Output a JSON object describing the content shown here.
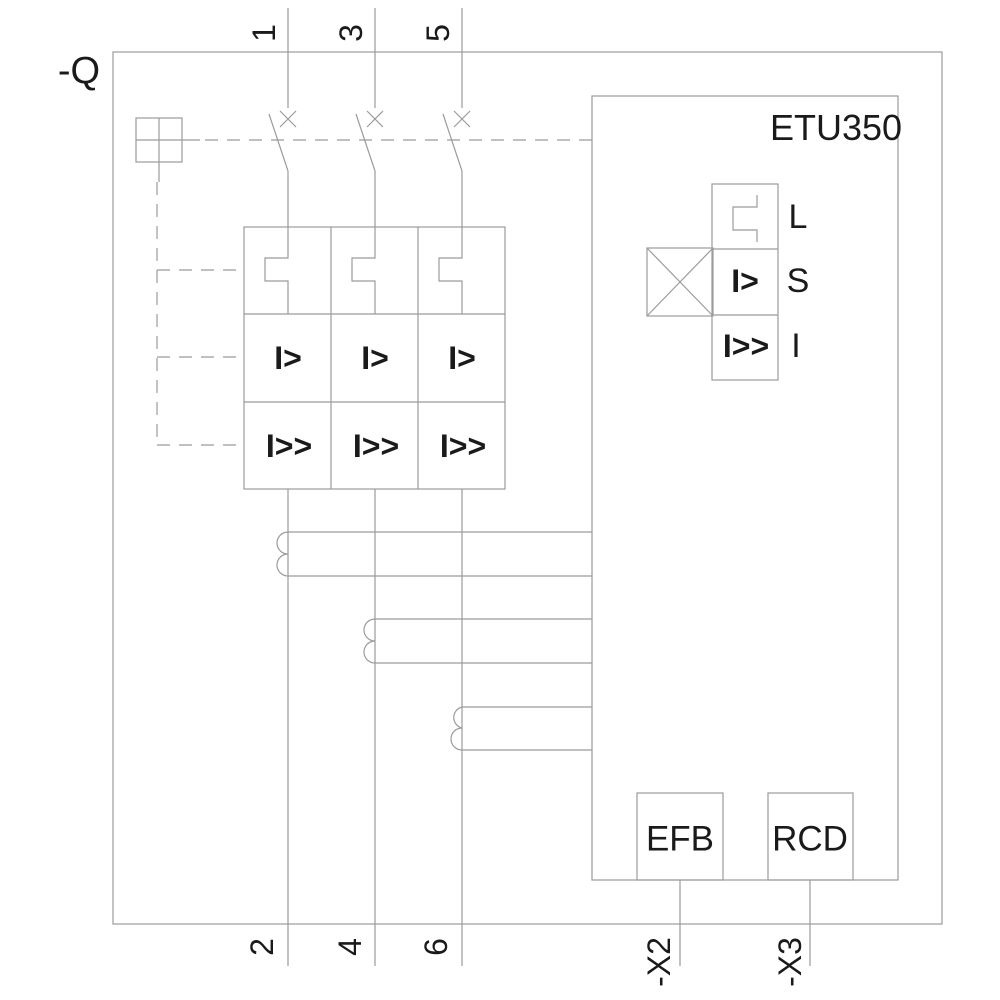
{
  "schematic": {
    "breaker_label": "-Q",
    "top_terminals": [
      "1",
      "3",
      "5"
    ],
    "bottom_terminals": [
      "2",
      "4",
      "6"
    ],
    "pole_symbols": {
      "overcurrent": "I>",
      "instantaneous": "I>>"
    },
    "etu": {
      "title": "ETU350",
      "functions": [
        {
          "label": "L",
          "symbol": ""
        },
        {
          "label": "S",
          "symbol": "I>"
        },
        {
          "label": "I",
          "symbol": "I>>"
        }
      ]
    },
    "modules": [
      {
        "label": "EFB",
        "terminal": "-X2"
      },
      {
        "label": "RCD",
        "terminal": "-X3"
      }
    ]
  },
  "colors": {
    "line": "#9b9b9b",
    "text": "#1a1a1a",
    "background": "#ffffff"
  }
}
